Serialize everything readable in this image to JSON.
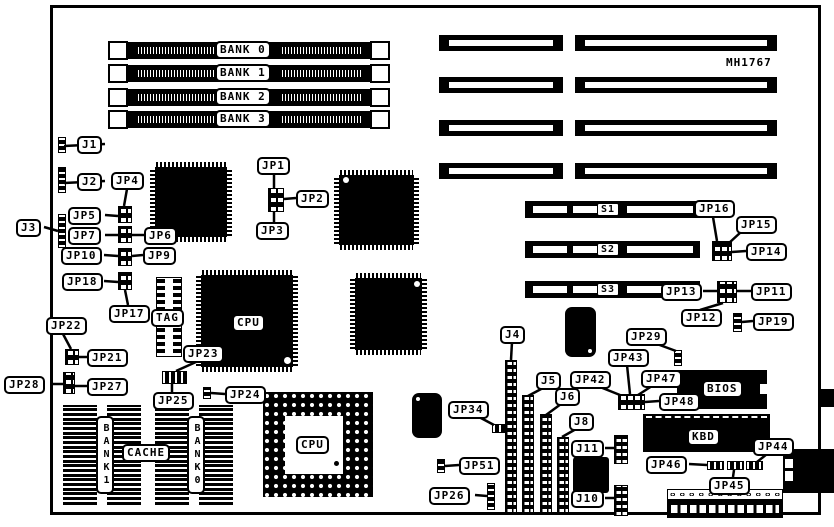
{
  "board": {
    "part_number": "MH1767"
  },
  "memory": {
    "banks": [
      "BANK 0",
      "BANK 1",
      "BANK 2",
      "BANK 3"
    ]
  },
  "slots": {
    "s1": "S1",
    "s2": "S2",
    "s3": "S3"
  },
  "chips": {
    "cpu_qfp": "CPU",
    "cpu_socket": "CPU",
    "tag": "TAG",
    "cache": "CACHE",
    "cache_bank1": "BANK1",
    "cache_bank0": "BANK0",
    "bios": "BIOS",
    "kbd": "KBD"
  },
  "callouts": {
    "j1": "J1",
    "j2": "J2",
    "j3": "J3",
    "j4": "J4",
    "j5": "J5",
    "j6": "J6",
    "j8": "J8",
    "j10": "J10",
    "j11": "J11",
    "jp1": "JP1",
    "jp2": "JP2",
    "jp3": "JP3",
    "jp4": "JP4",
    "jp5": "JP5",
    "jp6": "JP6",
    "jp7": "JP7",
    "jp9": "JP9",
    "jp10": "JP10",
    "jp11": "JP11",
    "jp12": "JP12",
    "jp13": "JP13",
    "jp14": "JP14",
    "jp15": "JP15",
    "jp16": "JP16",
    "jp17": "JP17",
    "jp18": "JP18",
    "jp19": "JP19",
    "jp21": "JP21",
    "jp22": "JP22",
    "jp23": "JP23",
    "jp24": "JP24",
    "jp25": "JP25",
    "jp26": "JP26",
    "jp27": "JP27",
    "jp28": "JP28",
    "jp29": "JP29",
    "jp34": "JP34",
    "jp42": "JP42",
    "jp43": "JP43",
    "jp44": "JP44",
    "jp45": "JP45",
    "jp46": "JP46",
    "jp47": "JP47",
    "jp48": "JP48",
    "jp51": "JP51"
  }
}
